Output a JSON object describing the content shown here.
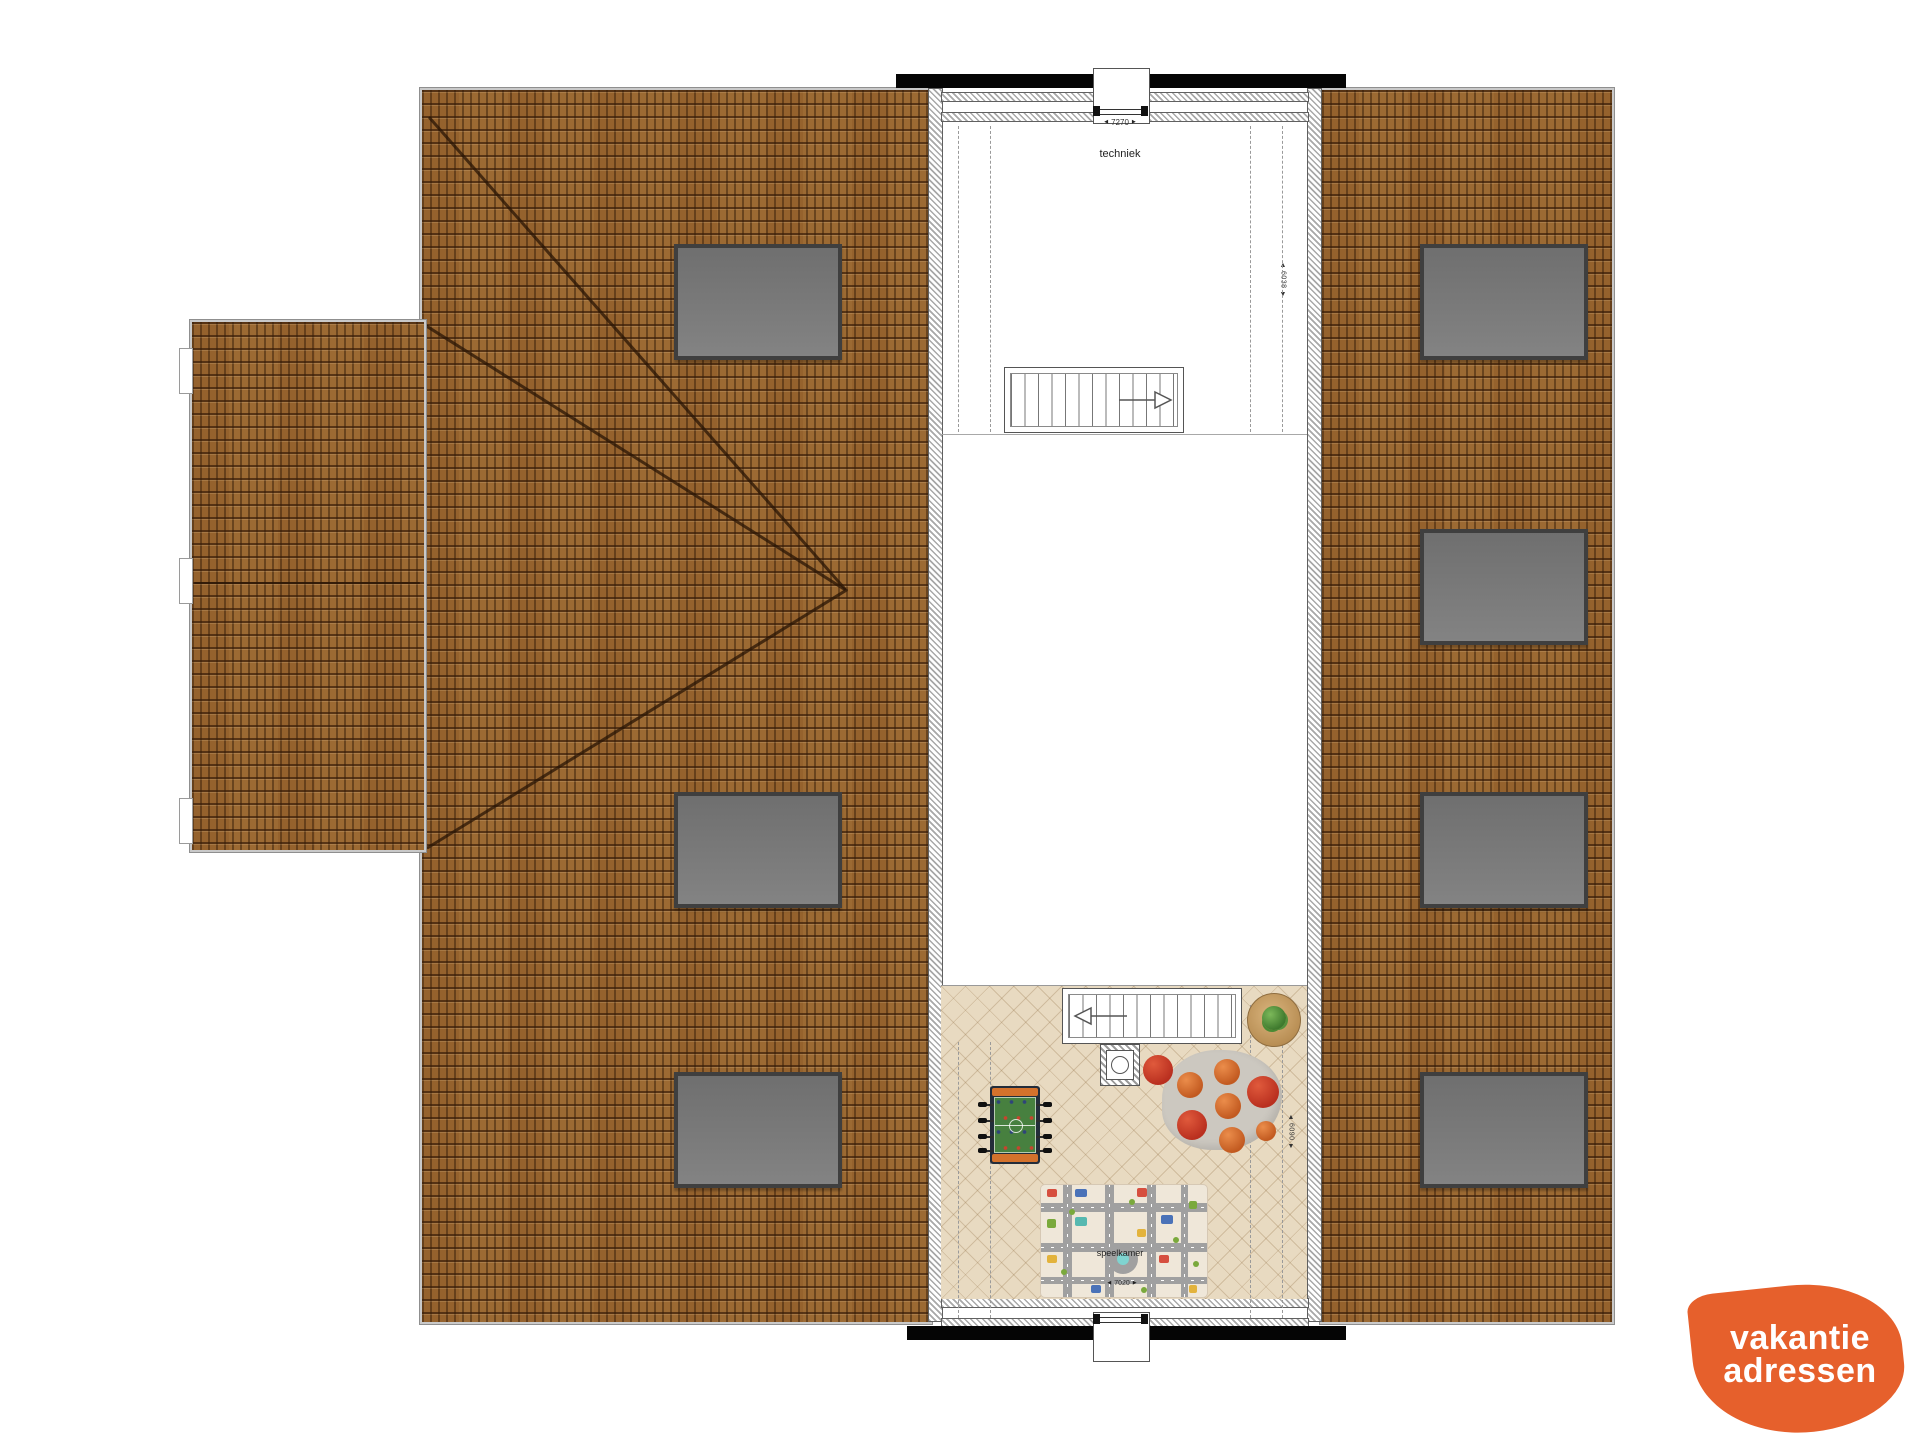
{
  "rooms": {
    "techniek": {
      "label": "techniek",
      "width_dim": "7270",
      "depth_dim": "6038"
    },
    "speelkamer": {
      "label": "speelkamer",
      "width_dim": "7020",
      "depth_dim": "6090"
    }
  },
  "icons": {
    "arrow_left": "◀",
    "arrow_right": "▶",
    "arrow_up": "▲",
    "arrow_down": "▼"
  },
  "roof_windows": {
    "left_roof_count": 3,
    "right_roof_count": 4
  },
  "colors": {
    "roof_tile": "#9c6a33",
    "roof_window": "#7d7d7d",
    "structural_wall": "#050505",
    "wood_floor": "#e8dac1",
    "rug": "#ccc8c0",
    "bean_bag_red": "#c63928",
    "bean_bag_orange": "#d0682c",
    "play_mat": "#efe7d9",
    "logo_orange": "#e6602c"
  },
  "logo": {
    "line1": "vakantie",
    "line2": "adressen"
  }
}
